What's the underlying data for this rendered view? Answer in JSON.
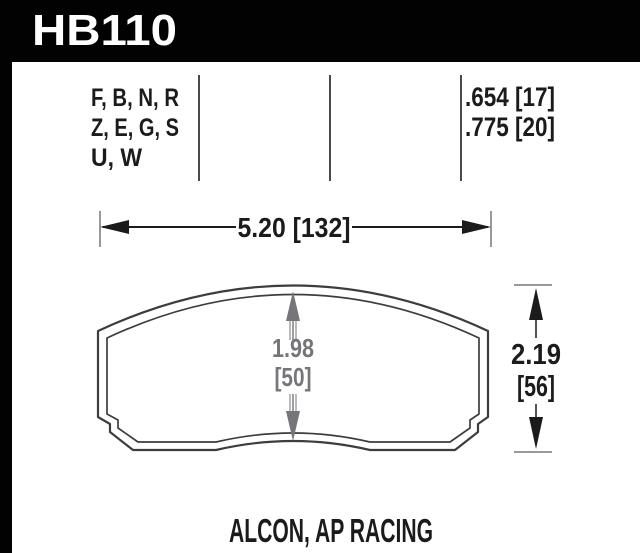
{
  "header": {
    "part_number": "HB110"
  },
  "compound_table": {
    "letters": [
      "F, B, N, R",
      "Z, E, G, S",
      "U, W"
    ],
    "thickness_values": [
      ".654 [17]",
      ".775 [20]"
    ]
  },
  "dimensions": {
    "width": "5.20 [132]",
    "pad_height_in": "1.98",
    "pad_height_mm": "[50]",
    "overall_height_in": "2.19",
    "overall_height_mm": "[56]"
  },
  "caliper": "ALCON, AP RACING",
  "colors": {
    "header_bg": "#000000",
    "header_text": "#ffffff",
    "body_text": "#1b1b1b",
    "dim_gray": "#76767a",
    "outline": "#3d3d3d"
  }
}
